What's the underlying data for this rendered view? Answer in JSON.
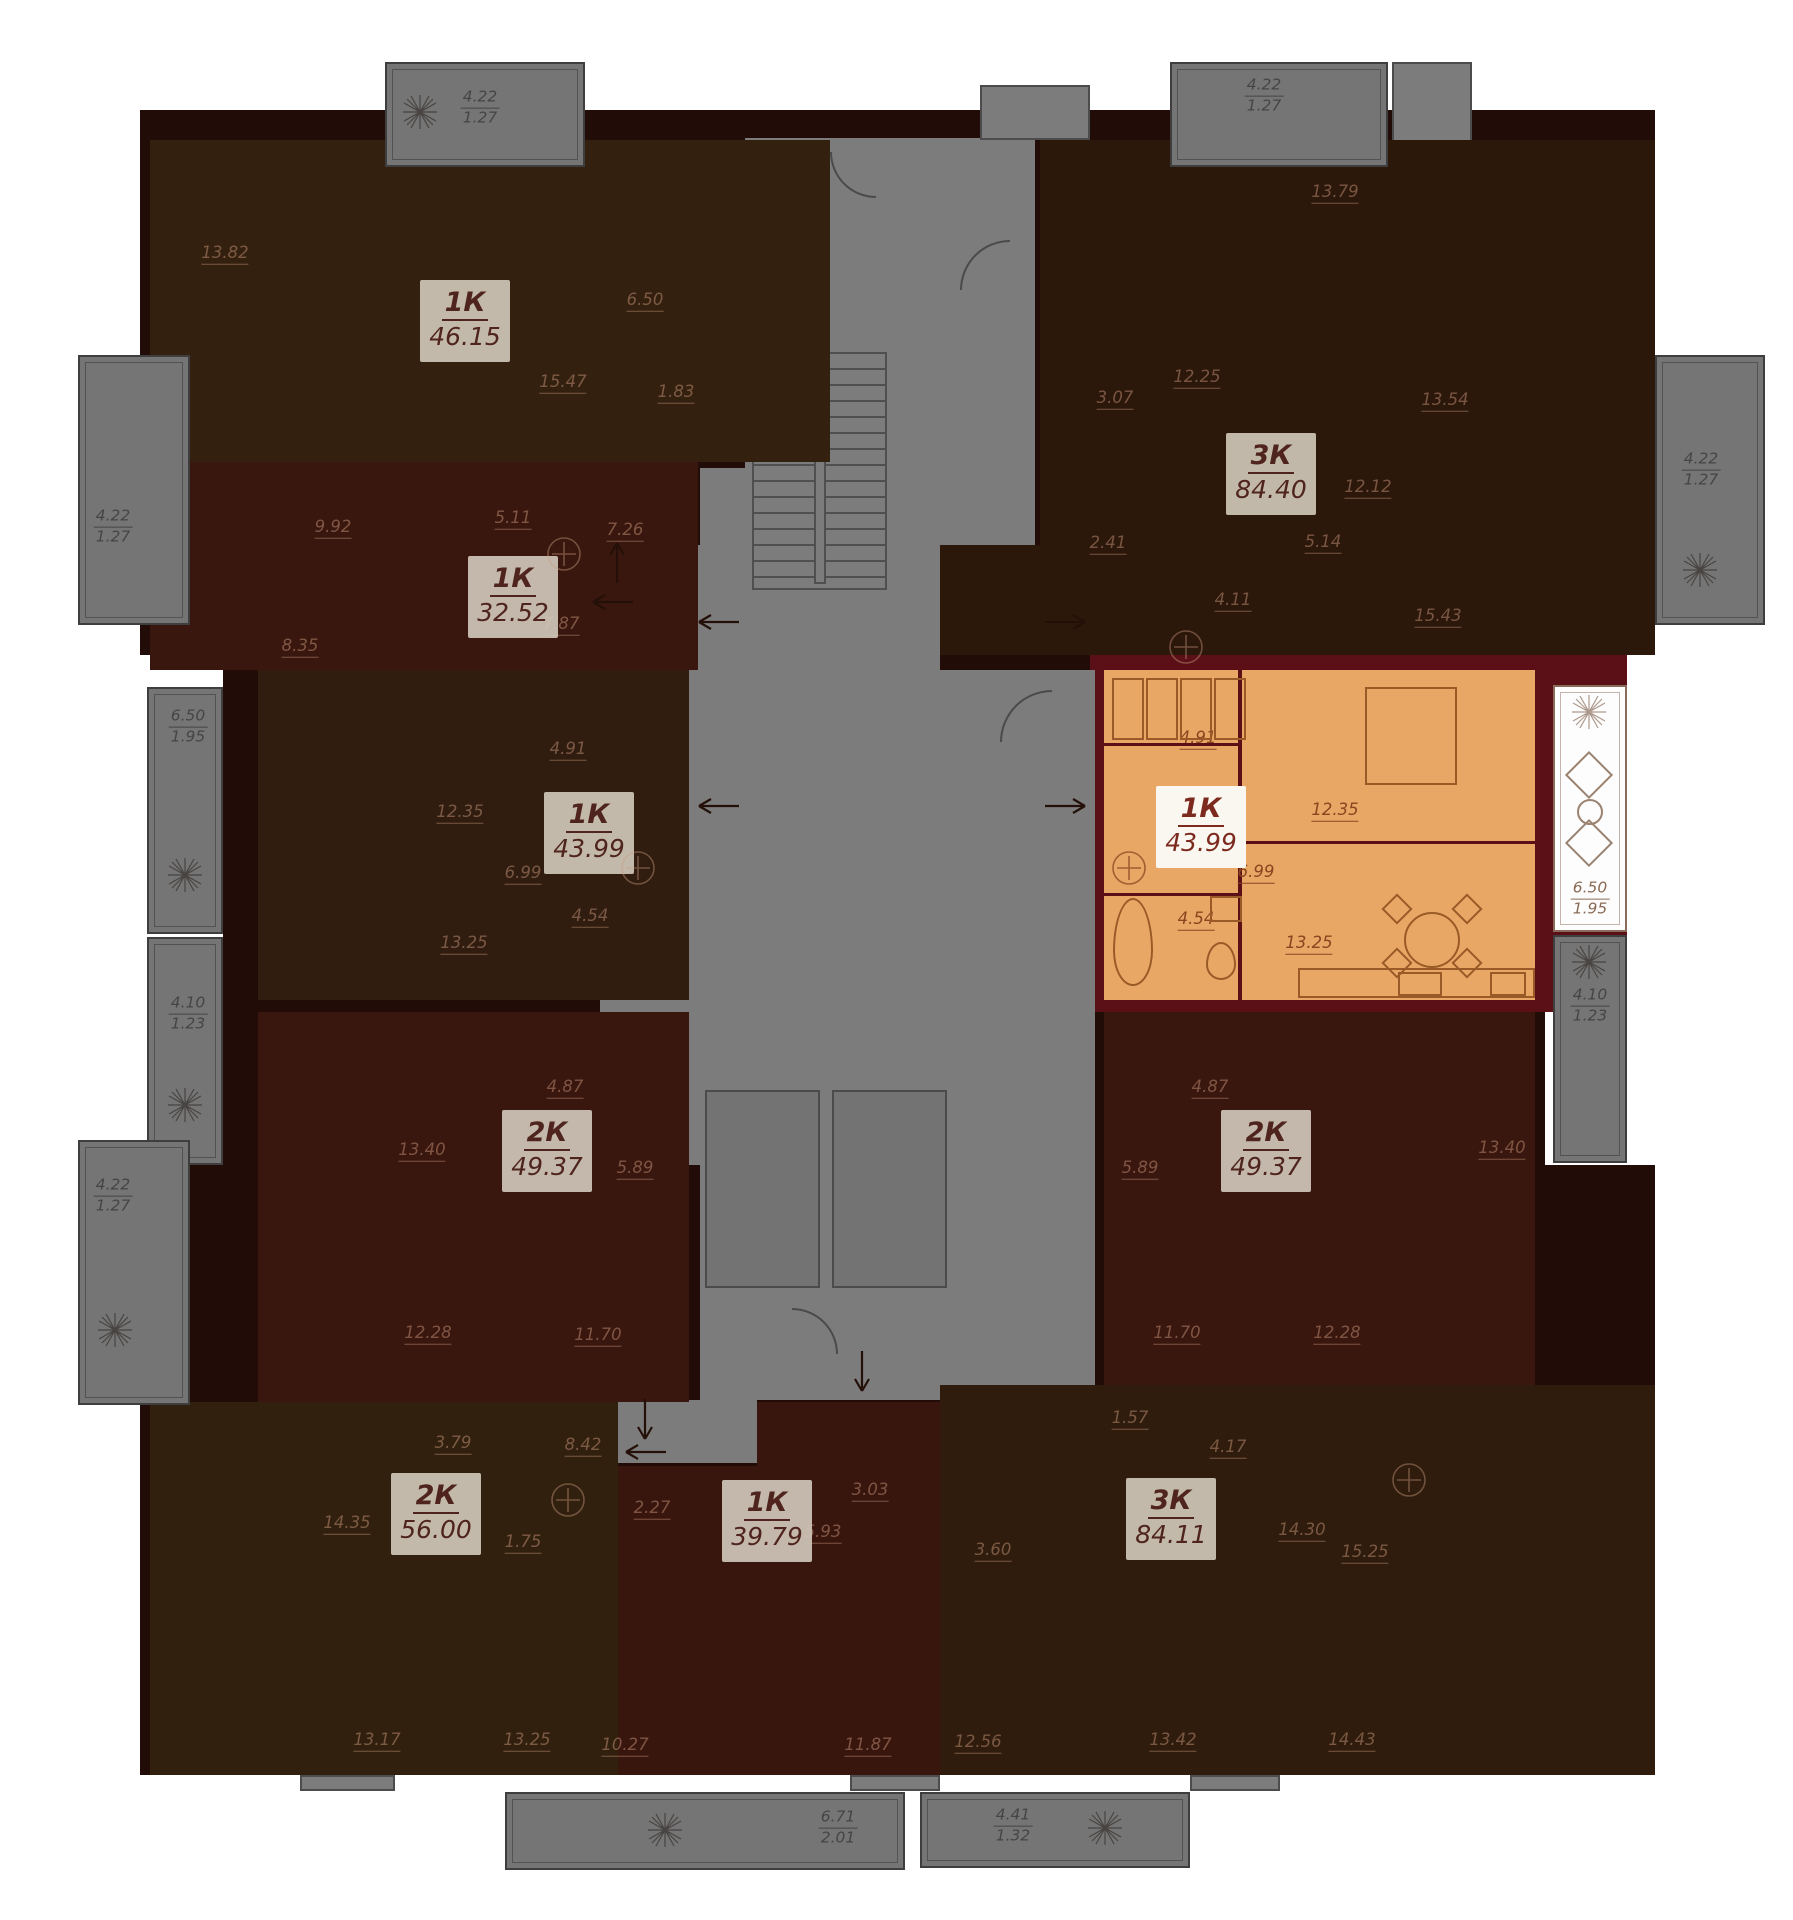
{
  "colors": {
    "page_bg": "#ffffff",
    "wall": "#220c08",
    "selected_wall": "#5a1016",
    "corridor": "#7c7c7c",
    "selected_fill": "#e9a766",
    "card_bg": "#cfc7b9",
    "card_text": "#4f241e",
    "selected_card_bg": "#faf7f0",
    "selected_card_text": "#7c2a1e"
  },
  "building": {
    "mass": [
      {
        "x": 140,
        "y": 110,
        "w": 1515,
        "h": 545
      },
      {
        "x": 223,
        "y": 655,
        "w": 1322,
        "h": 510
      },
      {
        "x": 140,
        "y": 1165,
        "w": 1515,
        "h": 610
      }
    ],
    "selected_wall_pieces": [
      {
        "x": 1090,
        "y": 655,
        "w": 460,
        "h": 17
      },
      {
        "x": 1090,
        "y": 655,
        "w": 16,
        "h": 357
      },
      {
        "x": 1090,
        "y": 996,
        "w": 460,
        "h": 16
      },
      {
        "x": 1530,
        "y": 560,
        "w": 97,
        "h": 452
      }
    ]
  },
  "core": {
    "rects": [
      {
        "x": 745,
        "y": 138,
        "w": 290,
        "h": 475
      },
      {
        "x": 700,
        "y": 468,
        "w": 240,
        "h": 205
      },
      {
        "x": 700,
        "y": 670,
        "w": 395,
        "h": 730
      },
      {
        "x": 600,
        "y": 545,
        "w": 102,
        "h": 620
      },
      {
        "x": 615,
        "y": 1400,
        "w": 142,
        "h": 63
      }
    ],
    "stubs": [
      {
        "x": 980,
        "y": 85,
        "w": 110,
        "h": 55
      },
      {
        "x": 1392,
        "y": 62,
        "w": 80,
        "h": 95
      },
      {
        "x": 300,
        "y": 1775,
        "w": 95,
        "h": 16
      },
      {
        "x": 850,
        "y": 1775,
        "w": 90,
        "h": 16
      },
      {
        "x": 1190,
        "y": 1775,
        "w": 90,
        "h": 16
      }
    ],
    "stair": {
      "x": 752,
      "y": 352,
      "w": 135,
      "h": 238
    },
    "elevators": [
      {
        "x": 705,
        "y": 1090,
        "w": 115,
        "h": 198
      },
      {
        "x": 832,
        "y": 1090,
        "w": 115,
        "h": 198
      }
    ],
    "arcs": [
      {
        "x": 830,
        "y": 152,
        "r": 46,
        "rot": 0
      },
      {
        "x": 960,
        "y": 240,
        "r": 50,
        "rot": 90
      },
      {
        "x": 1000,
        "y": 690,
        "r": 52,
        "rot": 90
      },
      {
        "x": 792,
        "y": 1308,
        "r": 46,
        "rot": 180
      }
    ]
  },
  "units": [
    {
      "code": "1k-46-15",
      "label": "1К",
      "area": "46.15",
      "fill": "#34200f",
      "highlighted": false,
      "regions": [
        {
          "x": 150,
          "y": 140,
          "w": 680,
          "h": 322
        }
      ],
      "card": {
        "x": 420,
        "y": 280
      },
      "rooms": [
        {
          "v": "13.82",
          "x": 225,
          "y": 253
        },
        {
          "v": "6.50",
          "x": 645,
          "y": 300
        },
        {
          "v": "1.83",
          "x": 676,
          "y": 392
        },
        {
          "v": "15.47",
          "x": 563,
          "y": 382
        }
      ]
    },
    {
      "code": "1k-32-52",
      "label": "1К",
      "area": "32.52",
      "fill": "#39170e",
      "highlighted": false,
      "regions": [
        {
          "x": 150,
          "y": 462,
          "w": 548,
          "h": 208
        }
      ],
      "card": {
        "x": 468,
        "y": 556
      },
      "rooms": [
        {
          "v": "9.92",
          "x": 333,
          "y": 527
        },
        {
          "v": "5.11",
          "x": 513,
          "y": 518
        },
        {
          "v": "7.26",
          "x": 625,
          "y": 530
        },
        {
          "v": "8.35",
          "x": 300,
          "y": 646
        },
        {
          "v": "7.87",
          "x": 561,
          "y": 624
        }
      ]
    },
    {
      "code": "1k-43-99",
      "label": "1К",
      "area": "43.99",
      "fill": "#301d10",
      "highlighted": false,
      "regions": [
        {
          "x": 258,
          "y": 670,
          "w": 431,
          "h": 330
        }
      ],
      "card": {
        "x": 544,
        "y": 792
      },
      "rooms": [
        {
          "v": "4.91",
          "x": 568,
          "y": 749
        },
        {
          "v": "12.35",
          "x": 460,
          "y": 812
        },
        {
          "v": "6.99",
          "x": 523,
          "y": 873
        },
        {
          "v": "4.54",
          "x": 590,
          "y": 916
        },
        {
          "v": "13.25",
          "x": 464,
          "y": 943
        }
      ]
    },
    {
      "code": "1k-43-99-selected",
      "label": "1К",
      "area": "43.99",
      "fill": "#e9a766",
      "highlighted": true,
      "regions": [
        {
          "x": 1104,
          "y": 670,
          "w": 431,
          "h": 330
        }
      ],
      "card": {
        "x": 1156,
        "y": 786
      },
      "rooms": [
        {
          "v": "4.91",
          "x": 1198,
          "y": 738
        },
        {
          "v": "12.35",
          "x": 1335,
          "y": 810
        },
        {
          "v": "6.99",
          "x": 1256,
          "y": 872
        },
        {
          "v": "4.54",
          "x": 1196,
          "y": 919
        },
        {
          "v": "13.25",
          "x": 1309,
          "y": 943
        }
      ],
      "walls": [
        {
          "x": 1238,
          "y": 670,
          "w": 4,
          "h": 330
        },
        {
          "x": 1104,
          "y": 743,
          "w": 136,
          "h": 3
        },
        {
          "x": 1104,
          "y": 893,
          "w": 136,
          "h": 3
        },
        {
          "x": 1240,
          "y": 841,
          "w": 295,
          "h": 3
        }
      ]
    },
    {
      "code": "2k-49-37-left",
      "label": "2К",
      "area": "49.37",
      "fill": "#39160e",
      "highlighted": false,
      "regions": [
        {
          "x": 258,
          "y": 1012,
          "w": 431,
          "h": 390
        }
      ],
      "card": {
        "x": 502,
        "y": 1110
      },
      "rooms": [
        {
          "v": "13.40",
          "x": 422,
          "y": 1150
        },
        {
          "v": "4.87",
          "x": 565,
          "y": 1087
        },
        {
          "v": "5.89",
          "x": 635,
          "y": 1168
        },
        {
          "v": "12.28",
          "x": 428,
          "y": 1333
        },
        {
          "v": "11.70",
          "x": 598,
          "y": 1335
        }
      ]
    },
    {
      "code": "2k-49-37-right",
      "label": "2К",
      "area": "49.37",
      "fill": "#39160e",
      "highlighted": false,
      "regions": [
        {
          "x": 1104,
          "y": 1012,
          "w": 431,
          "h": 390
        }
      ],
      "card": {
        "x": 1221,
        "y": 1110
      },
      "rooms": [
        {
          "v": "4.87",
          "x": 1210,
          "y": 1087
        },
        {
          "v": "5.89",
          "x": 1140,
          "y": 1168
        },
        {
          "v": "13.40",
          "x": 1502,
          "y": 1148
        },
        {
          "v": "11.70",
          "x": 1177,
          "y": 1333
        },
        {
          "v": "12.28",
          "x": 1337,
          "y": 1333
        }
      ]
    },
    {
      "code": "2k-56-00",
      "label": "2К",
      "area": "56.00",
      "fill": "#32200f",
      "highlighted": false,
      "regions": [
        {
          "x": 150,
          "y": 1402,
          "w": 468,
          "h": 373
        }
      ],
      "card": {
        "x": 391,
        "y": 1473
      },
      "rooms": [
        {
          "v": "14.35",
          "x": 347,
          "y": 1523
        },
        {
          "v": "3.79",
          "x": 453,
          "y": 1443
        },
        {
          "v": "8.42",
          "x": 583,
          "y": 1445
        },
        {
          "v": "1.75",
          "x": 523,
          "y": 1542
        },
        {
          "v": "13.17",
          "x": 377,
          "y": 1740
        },
        {
          "v": "13.25",
          "x": 527,
          "y": 1740
        }
      ]
    },
    {
      "code": "1k-39-79",
      "label": "1К",
      "area": "39.79",
      "fill": "#38160e",
      "highlighted": false,
      "regions": [
        {
          "x": 618,
          "y": 1466,
          "w": 322,
          "h": 309
        },
        {
          "x": 757,
          "y": 1402,
          "w": 183,
          "h": 64
        }
      ],
      "card": {
        "x": 722,
        "y": 1480
      },
      "rooms": [
        {
          "v": "2.27",
          "x": 652,
          "y": 1508
        },
        {
          "v": "3.03",
          "x": 870,
          "y": 1490
        },
        {
          "v": "5.93",
          "x": 823,
          "y": 1532
        },
        {
          "v": "10.27",
          "x": 625,
          "y": 1745
        },
        {
          "v": "11.87",
          "x": 868,
          "y": 1745
        }
      ]
    },
    {
      "code": "3k-84-11",
      "label": "3К",
      "area": "84.11",
      "fill": "#2f1c0d",
      "highlighted": false,
      "regions": [
        {
          "x": 940,
          "y": 1385,
          "w": 715,
          "h": 390
        }
      ],
      "card": {
        "x": 1126,
        "y": 1478
      },
      "rooms": [
        {
          "v": "1.57",
          "x": 1130,
          "y": 1418
        },
        {
          "v": "4.17",
          "x": 1228,
          "y": 1447
        },
        {
          "v": "3.60",
          "x": 993,
          "y": 1550
        },
        {
          "v": "14.30",
          "x": 1302,
          "y": 1530
        },
        {
          "v": "15.25",
          "x": 1365,
          "y": 1552
        },
        {
          "v": "12.56",
          "x": 978,
          "y": 1742
        },
        {
          "v": "13.42",
          "x": 1173,
          "y": 1740
        },
        {
          "v": "14.43",
          "x": 1352,
          "y": 1740
        }
      ]
    },
    {
      "code": "3k-84-40",
      "label": "3К",
      "area": "84.40",
      "fill": "#2c170b",
      "highlighted": false,
      "regions": [
        {
          "x": 1040,
          "y": 140,
          "w": 615,
          "h": 515
        },
        {
          "x": 940,
          "y": 545,
          "w": 595,
          "h": 110
        }
      ],
      "card": {
        "x": 1226,
        "y": 433
      },
      "rooms": [
        {
          "v": "13.79",
          "x": 1335,
          "y": 192
        },
        {
          "v": "12.25",
          "x": 1197,
          "y": 377
        },
        {
          "v": "3.07",
          "x": 1115,
          "y": 398
        },
        {
          "v": "13.54",
          "x": 1445,
          "y": 400
        },
        {
          "v": "12.12",
          "x": 1368,
          "y": 487
        },
        {
          "v": "2.41",
          "x": 1108,
          "y": 543
        },
        {
          "v": "5.14",
          "x": 1323,
          "y": 542
        },
        {
          "v": "4.11",
          "x": 1233,
          "y": 600
        },
        {
          "v": "15.43",
          "x": 1438,
          "y": 616
        }
      ]
    }
  ],
  "balconies": [
    {
      "area": "4.22",
      "coef": "1.27",
      "x": 385,
      "y": 62,
      "w": 200,
      "h": 105,
      "variant": "gray",
      "label": {
        "x": 480,
        "y": 108
      },
      "plant": {
        "x": 420,
        "y": 112
      }
    },
    {
      "area": "4.22",
      "coef": "1.27",
      "x": 1170,
      "y": 62,
      "w": 218,
      "h": 105,
      "variant": "gray",
      "label": {
        "x": 1264,
        "y": 96
      },
      "plant": null
    },
    {
      "area": "4.22",
      "coef": "1.27",
      "x": 78,
      "y": 355,
      "w": 112,
      "h": 270,
      "variant": "gray",
      "label": {
        "x": 113,
        "y": 527
      },
      "plant": null
    },
    {
      "area": "4.22",
      "coef": "1.27",
      "x": 1655,
      "y": 355,
      "w": 110,
      "h": 270,
      "variant": "gray",
      "label": {
        "x": 1701,
        "y": 470
      },
      "plant": {
        "x": 1700,
        "y": 570
      }
    },
    {
      "area": "6.50",
      "coef": "1.95",
      "x": 147,
      "y": 687,
      "w": 76,
      "h": 247,
      "variant": "gray",
      "label": {
        "x": 188,
        "y": 727
      },
      "plant": {
        "x": 185,
        "y": 875
      }
    },
    {
      "area": "4.10",
      "coef": "1.23",
      "x": 147,
      "y": 937,
      "w": 76,
      "h": 228,
      "variant": "gray",
      "label": {
        "x": 188,
        "y": 1014
      },
      "plant": {
        "x": 185,
        "y": 1105
      }
    },
    {
      "area": "6.50",
      "coef": "1.95",
      "x": 1553,
      "y": 685,
      "w": 74,
      "h": 247,
      "variant": "white",
      "label": {
        "x": 1590,
        "y": 899
      },
      "plant": {
        "x": 1589,
        "y": 712
      }
    },
    {
      "area": "4.10",
      "coef": "1.23",
      "x": 1553,
      "y": 935,
      "w": 74,
      "h": 228,
      "variant": "gray",
      "label": {
        "x": 1590,
        "y": 1006
      },
      "plant": {
        "x": 1589,
        "y": 962
      }
    },
    {
      "area": "4.22",
      "coef": "1.27",
      "x": 78,
      "y": 1140,
      "w": 112,
      "h": 265,
      "variant": "gray",
      "label": {
        "x": 113,
        "y": 1196
      },
      "plant": {
        "x": 115,
        "y": 1330
      }
    },
    {
      "area": "6.71",
      "coef": "2.01",
      "x": 505,
      "y": 1792,
      "w": 400,
      "h": 78,
      "variant": "gray",
      "label": {
        "x": 838,
        "y": 1828
      },
      "plant": {
        "x": 665,
        "y": 1830
      }
    },
    {
      "area": "4.41",
      "coef": "1.32",
      "x": 920,
      "y": 1792,
      "w": 270,
      "h": 76,
      "variant": "gray",
      "label": {
        "x": 1013,
        "y": 1826
      },
      "plant": {
        "x": 1105,
        "y": 1828
      }
    }
  ],
  "furniture": [
    {
      "type": "wardrobe",
      "x": 1112,
      "y": 678,
      "w": 32,
      "h": 62
    },
    {
      "type": "wardrobe",
      "x": 1146,
      "y": 678,
      "w": 32,
      "h": 62
    },
    {
      "type": "wardrobe",
      "x": 1180,
      "y": 678,
      "w": 32,
      "h": 62
    },
    {
      "type": "wardrobe",
      "x": 1214,
      "y": 678,
      "w": 32,
      "h": 62
    },
    {
      "type": "bed",
      "x": 1365,
      "y": 687,
      "w": 92,
      "h": 98
    },
    {
      "type": "dining-table",
      "x": 1404,
      "y": 912,
      "w": 56,
      "h": 56,
      "shape": "circle"
    },
    {
      "type": "chair",
      "x": 1386,
      "y": 898,
      "w": 22,
      "h": 22,
      "rot": true
    },
    {
      "type": "chair",
      "x": 1456,
      "y": 898,
      "w": 22,
      "h": 22,
      "rot": true
    },
    {
      "type": "chair",
      "x": 1386,
      "y": 952,
      "w": 22,
      "h": 22,
      "rot": true
    },
    {
      "type": "chair",
      "x": 1456,
      "y": 952,
      "w": 22,
      "h": 22,
      "rot": true
    },
    {
      "type": "bathtub",
      "x": 1113,
      "y": 898,
      "w": 40,
      "h": 88,
      "shape": "ell"
    },
    {
      "type": "toilet",
      "x": 1206,
      "y": 942,
      "w": 30,
      "h": 38,
      "shape": "ell"
    },
    {
      "type": "washer",
      "x": 1210,
      "y": 896,
      "w": 32,
      "h": 26
    },
    {
      "type": "kitchen-counter",
      "x": 1298,
      "y": 968,
      "w": 237,
      "h": 30
    },
    {
      "type": "stove",
      "x": 1398,
      "y": 972,
      "w": 44,
      "h": 24
    },
    {
      "type": "sink",
      "x": 1490,
      "y": 972,
      "w": 36,
      "h": 24
    },
    {
      "type": "armchair",
      "x": 1572,
      "y": 758,
      "w": 34,
      "h": 34,
      "rot": true,
      "balc": true
    },
    {
      "type": "side-table",
      "x": 1577,
      "y": 799,
      "w": 26,
      "h": 26,
      "shape": "circle",
      "balc": true
    },
    {
      "type": "armchair",
      "x": 1572,
      "y": 826,
      "w": 34,
      "h": 34,
      "rot": true,
      "balc": true
    }
  ],
  "arrows": [
    {
      "x": 617,
      "y": 562,
      "dir": "up"
    },
    {
      "x": 612,
      "y": 602,
      "dir": "left"
    },
    {
      "x": 1066,
      "y": 622,
      "dir": "right"
    },
    {
      "x": 1066,
      "y": 806,
      "dir": "right"
    },
    {
      "x": 718,
      "y": 622,
      "dir": "left"
    },
    {
      "x": 718,
      "y": 806,
      "dir": "left"
    },
    {
      "x": 645,
      "y": 1420,
      "dir": "down"
    },
    {
      "x": 645,
      "y": 1452,
      "dir": "left"
    },
    {
      "x": 862,
      "y": 1372,
      "dir": "down"
    }
  ],
  "markers": [
    {
      "x": 564,
      "y": 554,
      "hl": false
    },
    {
      "x": 638,
      "y": 868,
      "hl": false
    },
    {
      "x": 1129,
      "y": 868,
      "hl": true
    },
    {
      "x": 1186,
      "y": 647,
      "hl": false
    },
    {
      "x": 568,
      "y": 1500,
      "hl": false
    },
    {
      "x": 1409,
      "y": 1480,
      "hl": false
    }
  ]
}
